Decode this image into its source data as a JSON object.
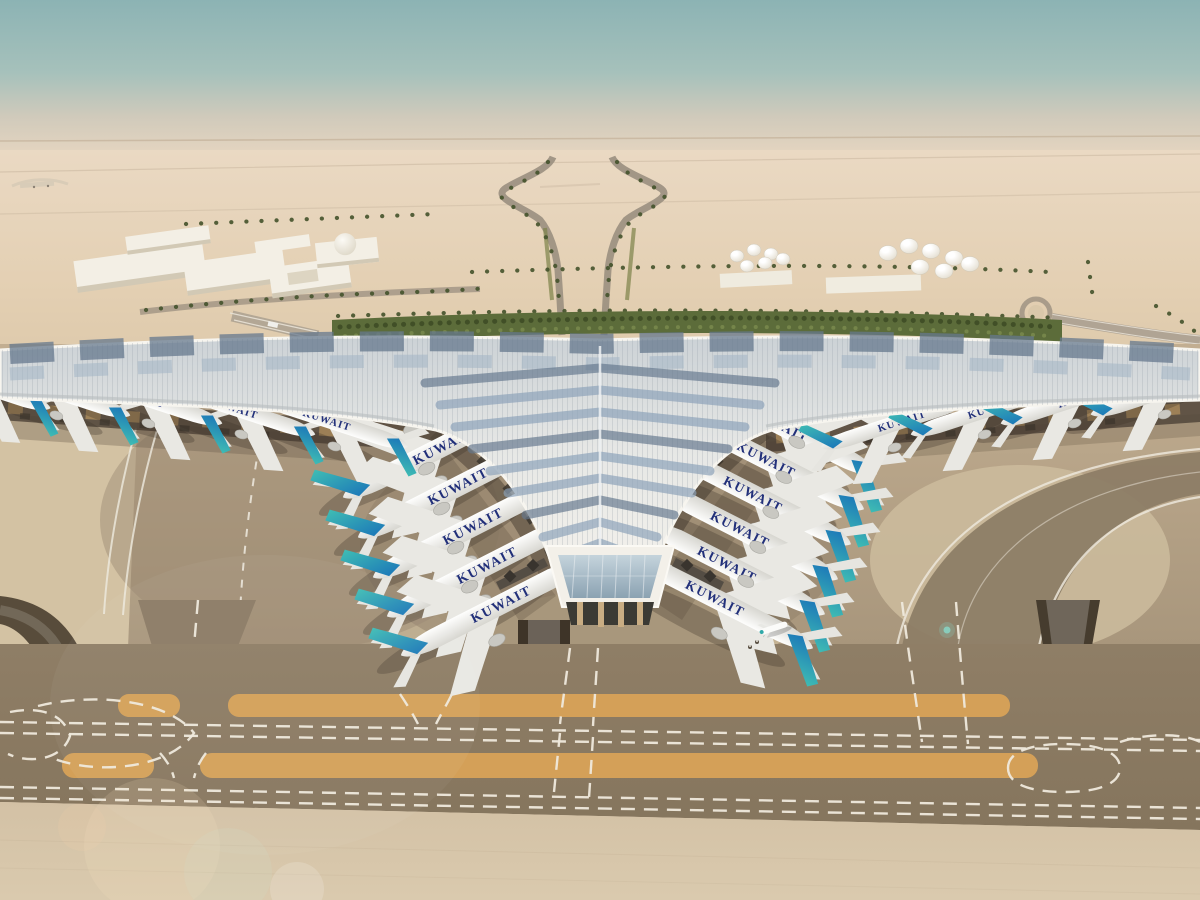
{
  "scene": {
    "description": "Aerial architectural rendering of a trident-shaped airport terminal with solar-panel roof in a desert, aircraft parked at gates, taxiways with markings in foreground",
    "airline_mark": "KUWAIT",
    "palette": {
      "sky_top": "#8cb3b4",
      "sky_haze": "#e9d7c1",
      "desert_sand": "#e3cfb2",
      "roof_white": "#f4f2ec",
      "solar_panel_blue": "#8ba1b8",
      "tail_teal": "#3fbcb4",
      "tail_blue": "#1d7ab8",
      "apron_concrete": "#c2ae91",
      "taxiway_asphalt": "#85755d",
      "shoulder_orange": "#d4a058",
      "marking_white": "#efe9dc",
      "vegetation_green": "#5c6c3a"
    },
    "counts": {
      "aircraft_at_gates": 20,
      "storage_tanks": 13
    }
  }
}
